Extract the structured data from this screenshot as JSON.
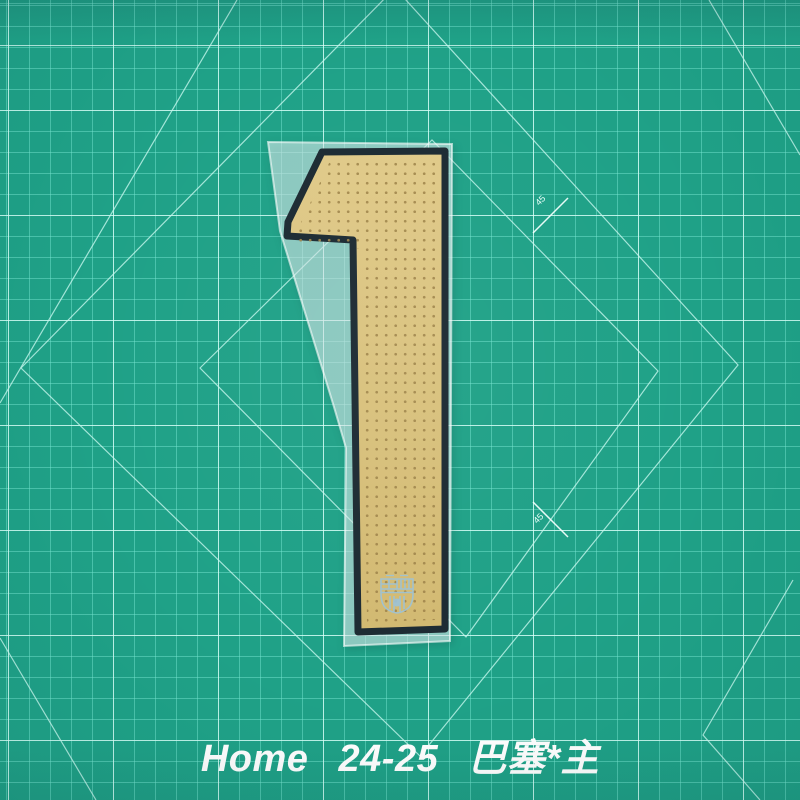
{
  "product_photo": {
    "caption": "Home  24-25  巴塞*主",
    "jersey_number": "1",
    "angle_labels": {
      "upper": "45",
      "lower": "45"
    }
  },
  "icons": {
    "crest": "fc-barcelona-crest"
  },
  "colors": {
    "mat_green": "#1fa187",
    "grid_minor": "#74e4cf",
    "grid_major": "#e0fff9",
    "number_gold": "#d9c17c",
    "perforation_dot": "#a0854a",
    "number_outline": "#1c2a32",
    "backing_film": "#eaf6f8",
    "caption_white": "#ffffff",
    "crest_blue": "#9cc2d6"
  }
}
